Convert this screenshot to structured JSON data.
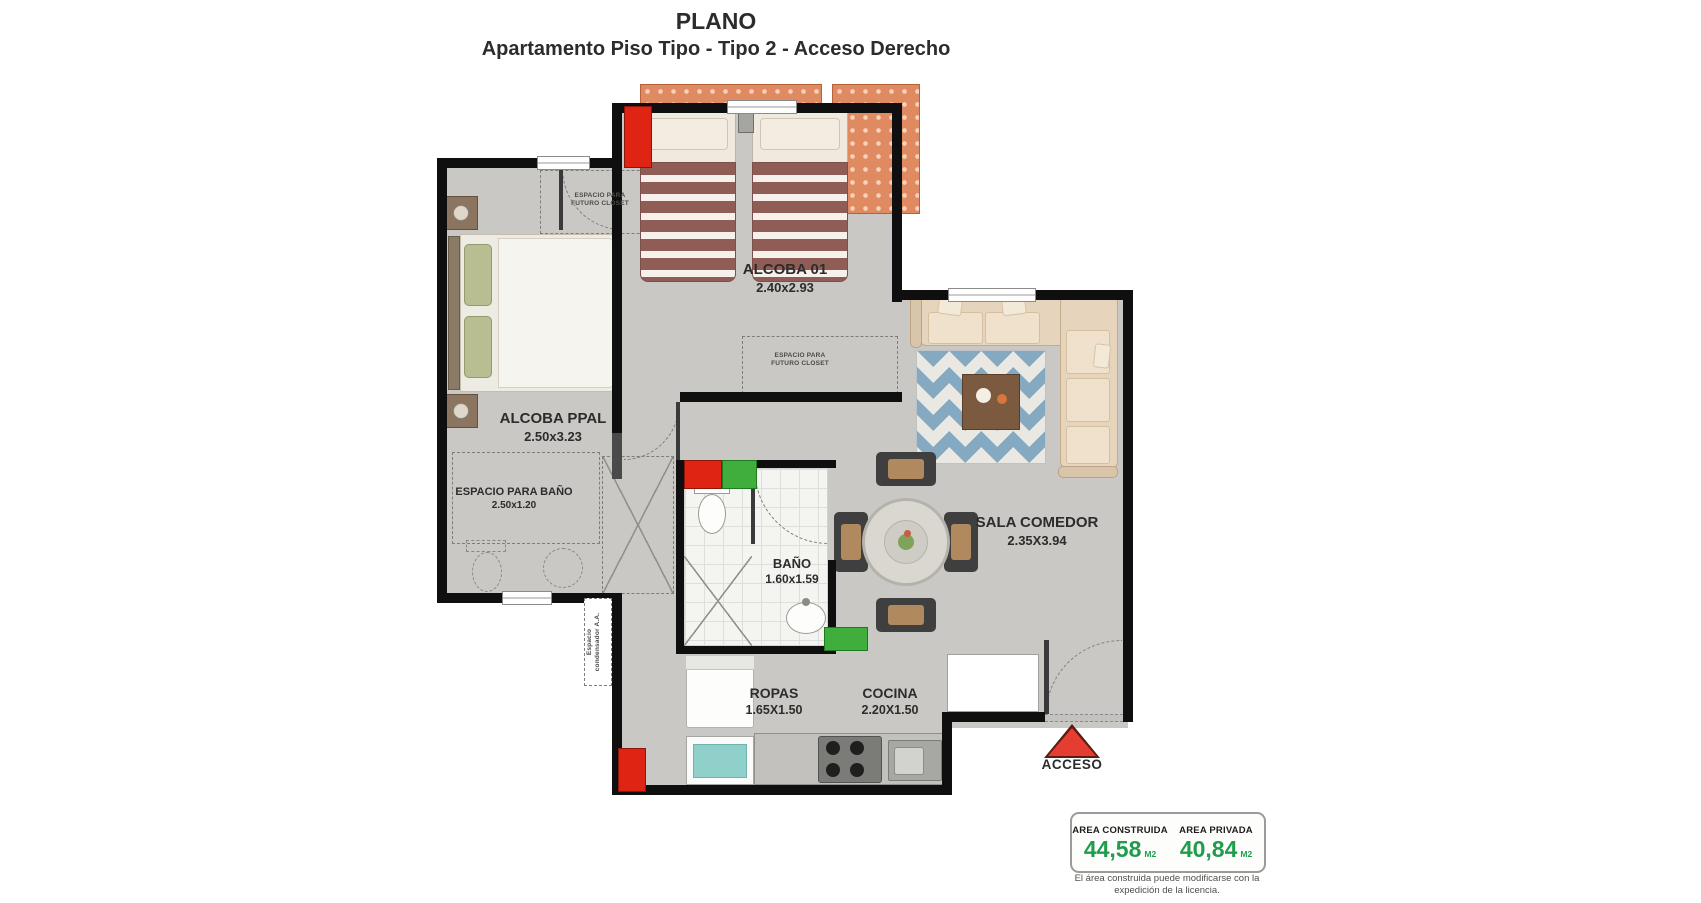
{
  "title": {
    "main": "PLANO",
    "subtitle": "Apartamento Piso Tipo - Tipo 2 - Acceso Derecho"
  },
  "rooms": {
    "alcoba01": {
      "name": "ALCOBA 01",
      "dims": "2.40x2.93"
    },
    "alcoba_ppal": {
      "name": "ALCOBA PPAL",
      "dims": "2.50x3.23"
    },
    "espacio_bano": {
      "name": "ESPACIO PARA BAÑO",
      "dims": "2.50x1.20"
    },
    "bano": {
      "name": "BAÑO",
      "dims": "1.60x1.59"
    },
    "sala_comedor": {
      "name": "SALA COMEDOR",
      "dims": "2.35X3.94"
    },
    "ropas": {
      "name": "ROPAS",
      "dims": "1.65X1.50"
    },
    "cocina": {
      "name": "COCINA",
      "dims": "2.20X1.50"
    }
  },
  "annotations": {
    "closet_ppal": "ESPACIO PARA\nFUTURO CLOSET",
    "closet_alcoba01": "ESPACIO PARA\nFUTURO CLOSET",
    "condensador": "Espacio\ncondensador A.A.",
    "acceso": "ACCESO"
  },
  "area_summary": {
    "construida": {
      "label": "AREA CONSTRUIDA",
      "value": "44,58",
      "unit": "M2"
    },
    "privada": {
      "label": "AREA PRIVADA",
      "value": "40,84",
      "unit": "M2"
    },
    "disclaimer": "El área construida puede modificarse con la expedición de la licencia."
  },
  "colors": {
    "accent_red": "#e02413",
    "accent_green": "#3fae3c",
    "balcony_orange": "#e08a62",
    "value_green": "#1f9d4d"
  }
}
